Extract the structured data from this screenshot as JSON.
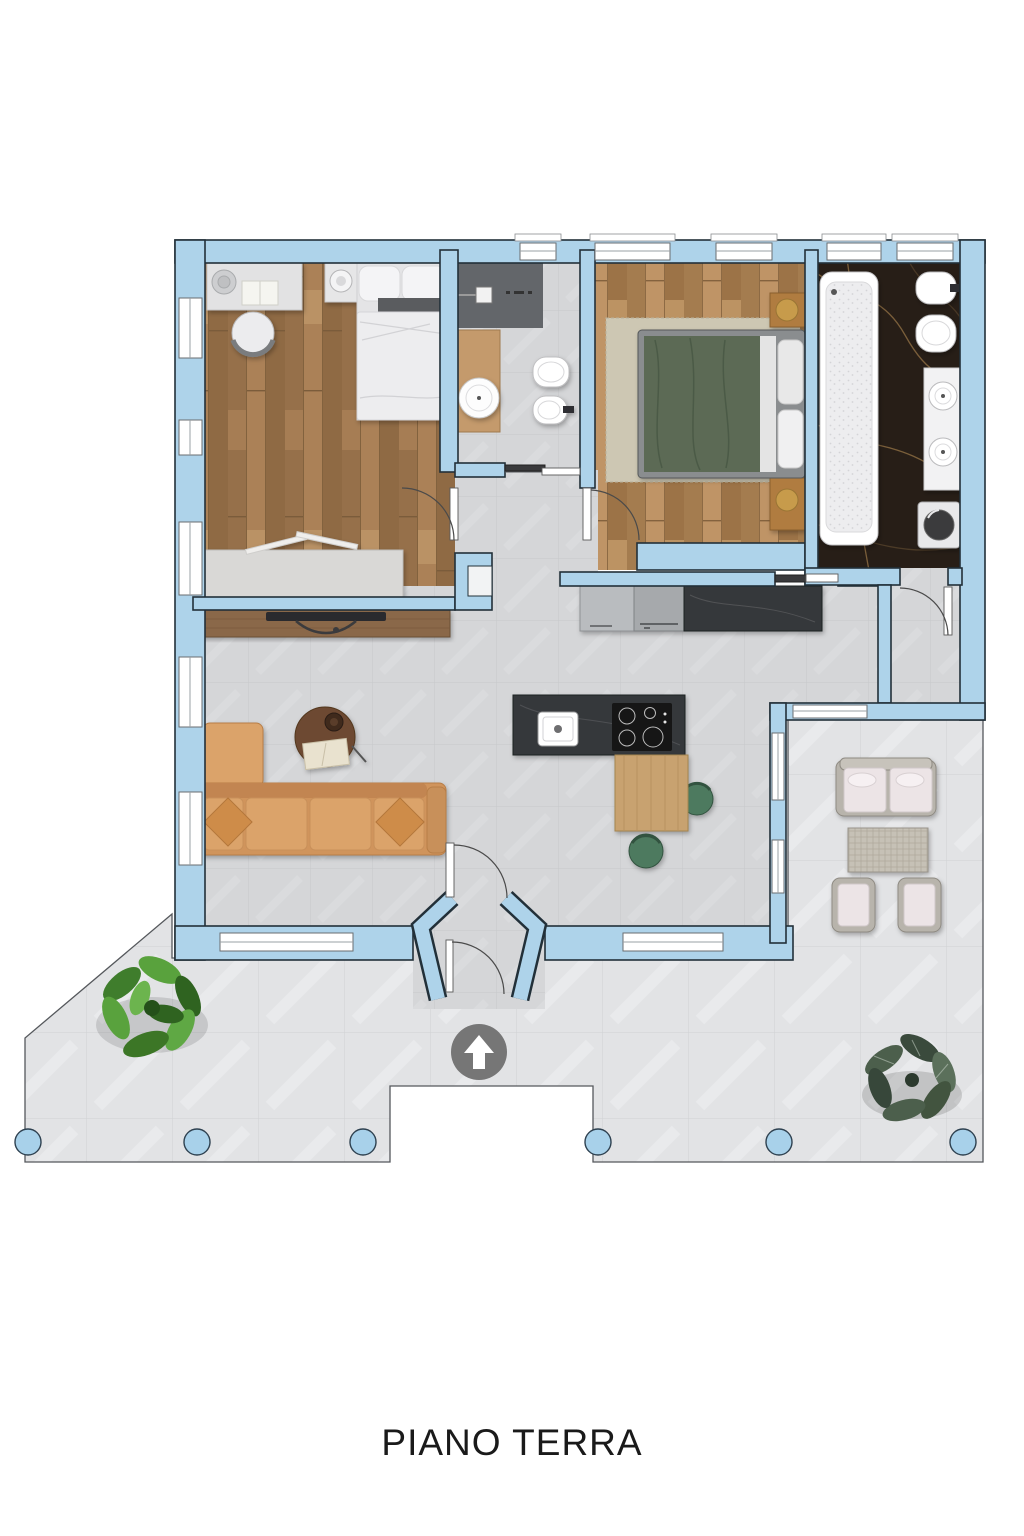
{
  "title": "PIANO TERRA",
  "colors": {
    "wall": "#aed3ea",
    "wall_outline": "#223039",
    "terrace_tile": "#e2e3e5",
    "interior_tile": "#d5d6d8",
    "wood_bedroom1": "#a07748",
    "wood_bedroom2": "#b2885a",
    "marble_dark": "#271e17",
    "counter_dark": "#35373a",
    "sofa_tan": "#d0945c",
    "chair_green": "#4e7a5f",
    "lamp_gold": "#c79b4c",
    "outdoor_cushion": "#ece4e6",
    "pillar_blue": "#a8d1ea",
    "arrow_badge": "#6f6f6f",
    "text": "#1a1a1a"
  },
  "plan": {
    "floor_label": "PIANO TERRA",
    "rooms": [
      {
        "name": "bedroom-1",
        "furniture": [
          "desk",
          "desk-chair",
          "double-bed",
          "nightstand-with-lamp",
          "wardrobe"
        ]
      },
      {
        "name": "bathroom-1",
        "furniture": [
          "shower",
          "round-washbasin-on-wood-counter",
          "toilet",
          "bidet",
          "sliding-door"
        ]
      },
      {
        "name": "bedroom-2",
        "furniture": [
          "double-bed-green-duvet",
          "area-rug",
          "nightstand-with-lamp",
          "bench-with-lamp"
        ]
      },
      {
        "name": "bathroom-2",
        "furniture": [
          "bathtub",
          "bidet",
          "toilet",
          "double-sink-vanity",
          "washing-machine"
        ]
      },
      {
        "name": "kitchen",
        "furniture": [
          "counter-with-fridge",
          "island-with-sink-and-induction-hob",
          "dining-table",
          "dining-chairs"
        ]
      },
      {
        "name": "living-room",
        "furniture": [
          "corner-sofa",
          "round-coffee-table",
          "tv-sideboard"
        ]
      },
      {
        "name": "entrance-vestibule",
        "furniture": [
          "entry-doors",
          "direction-arrow"
        ]
      },
      {
        "name": "covered-patio",
        "furniture": [
          "outdoor-sofa",
          "outdoor-coffee-table",
          "outdoor-armchairs"
        ]
      },
      {
        "name": "terrace",
        "furniture": [
          "plant-green",
          "plant-dark",
          "six-columns"
        ]
      }
    ]
  }
}
